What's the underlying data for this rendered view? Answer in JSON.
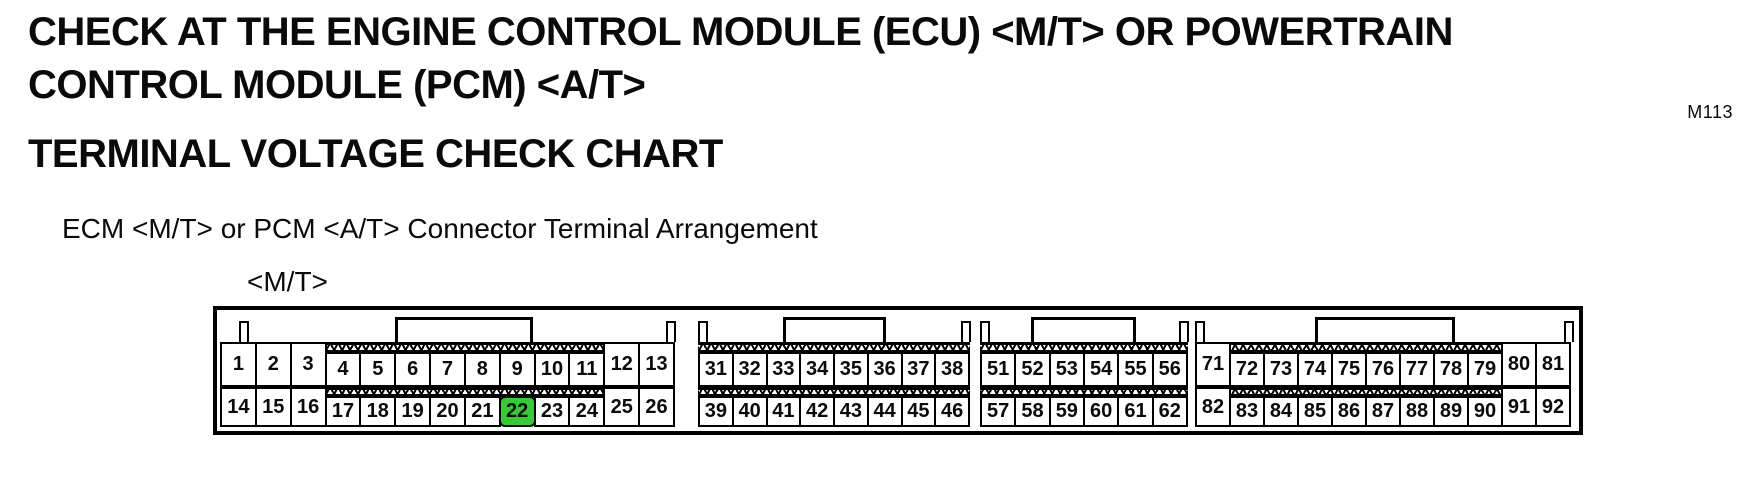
{
  "page": {
    "title": "CHECK AT THE ENGINE CONTROL MODULE (ECU) <M/T> OR POWERTRAIN CONTROL MODULE (PCM) <A/T>",
    "figure_code": "M113",
    "section_title": "TERMINAL VOLTAGE CHECK CHART",
    "diagram_caption": "ECM <M/T> or PCM <A/T> Connector Terminal Arrangement",
    "variant_label": "<M/T>"
  },
  "connector": {
    "highlighted_terminal": "22",
    "highlight_color": "#33cc33",
    "blocks": [
      {
        "name": "terminal-block-1",
        "top": [
          "1",
          "2",
          "3",
          "4",
          "5",
          "6",
          "7",
          "8",
          "9",
          "10",
          "11",
          "12",
          "13"
        ],
        "bottom": [
          "14",
          "15",
          "16",
          "17",
          "18",
          "19",
          "20",
          "21",
          "22",
          "23",
          "24",
          "25",
          "26"
        ],
        "hatch_start": 3,
        "hatch_end": 10
      },
      {
        "name": "terminal-block-2",
        "top": [
          "31",
          "32",
          "33",
          "34",
          "35",
          "36",
          "37",
          "38"
        ],
        "bottom": [
          "39",
          "40",
          "41",
          "42",
          "43",
          "44",
          "45",
          "46"
        ],
        "hatch_start": 0,
        "hatch_end": 7
      },
      {
        "name": "terminal-block-3",
        "top": [
          "51",
          "52",
          "53",
          "54",
          "55",
          "56"
        ],
        "bottom": [
          "57",
          "58",
          "59",
          "60",
          "61",
          "62"
        ],
        "hatch_start": 0,
        "hatch_end": 5
      },
      {
        "name": "terminal-block-4",
        "top": [
          "71",
          "72",
          "73",
          "74",
          "75",
          "76",
          "77",
          "78",
          "79",
          "80",
          "81"
        ],
        "bottom": [
          "82",
          "83",
          "84",
          "85",
          "86",
          "87",
          "88",
          "89",
          "90",
          "91",
          "92"
        ],
        "hatch_start": 1,
        "hatch_end": 8
      }
    ]
  }
}
